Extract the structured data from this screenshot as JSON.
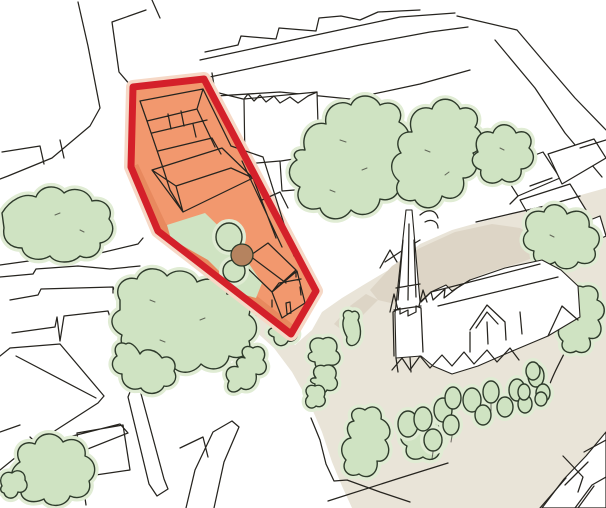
{
  "canvas": {
    "width": 606,
    "height": 508
  },
  "colors": {
    "background": "#ffffff",
    "ink": "#26241f",
    "site_fill": "#f2986e",
    "site_shade": "#dd7a4e",
    "site_outline": "#d4202a",
    "site_halo": "#f6d8c6",
    "tree_fill": "#cfe3c2",
    "tree_halo": "#e0ecd4",
    "tree_ink": "#2e3b2b",
    "tree_brown": "#b5835f",
    "ground": "#e9e4d8",
    "ground_shade": "#ddd5c6",
    "building_fill": "#ffffff"
  },
  "features": [
    "development-site-boundary",
    "development-site-buildings",
    "site-courtyard-lawn",
    "courtyard-trees",
    "church-with-spire",
    "churchyard-ground",
    "churchyard-tree-row",
    "street-network",
    "surrounding-buildings",
    "tree-canopies"
  ]
}
